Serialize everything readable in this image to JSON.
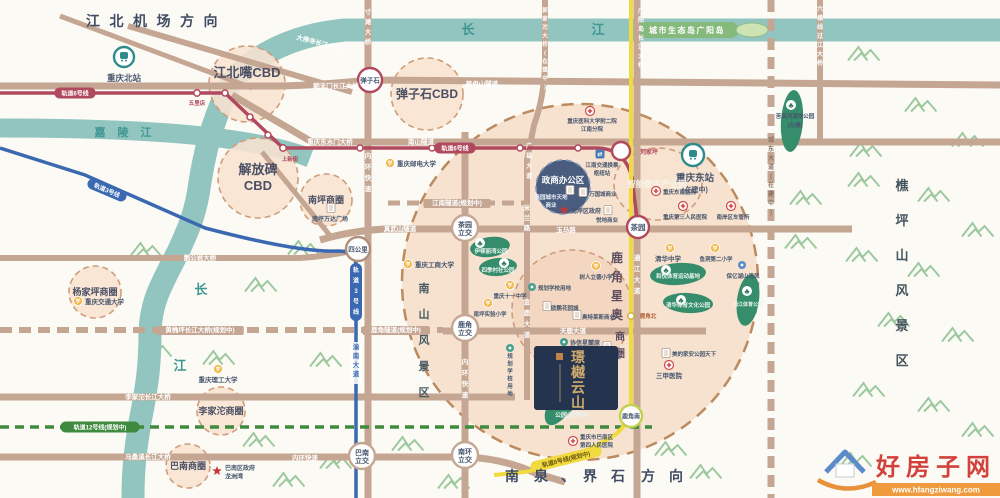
{
  "project": {
    "name": "璟樾云山"
  },
  "directions": {
    "airport": "江北机场方向",
    "south": "南泉、界石方向"
  },
  "rivers": {
    "yangtze": "长江",
    "jialing": "嘉陵江",
    "eco_island": "城市生态岛广阳岛"
  },
  "scenic": {
    "nanshan": "南山风景区",
    "qiaopingshan": "樵坪山风景区"
  },
  "metro_lines": [
    {
      "id": "line6",
      "label": "轨道6号线",
      "color": "#b0495e"
    },
    {
      "id": "line3",
      "label": "轨道3号线",
      "color": "#3a69b1"
    },
    {
      "id": "line12",
      "label": "轨道12号线(规划中)",
      "color": "#3e8a3e"
    },
    {
      "id": "line8",
      "label": "轨道8号线(规划中)",
      "color": "#f0da3d"
    }
  ],
  "metro_pills": [
    {
      "t": "轨道6号线",
      "x": 75,
      "y": 93,
      "c": "#b0495e"
    },
    {
      "t": "轨道6号线",
      "x": 455,
      "y": 148,
      "c": "#b0495e"
    },
    {
      "t": "轨道3号线",
      "x": 107,
      "y": 190,
      "c": "#3a69b1",
      "rot": 23
    },
    {
      "t": "轨道3号线",
      "x": 356,
      "y": 292,
      "c": "#3a69b1",
      "vert": 1
    },
    {
      "t": "轨道12号线(规划中)",
      "x": 100,
      "y": 427,
      "c": "#3e8a3e"
    },
    {
      "t": "轨道8号线(规划中)",
      "x": 566,
      "y": 459,
      "c": "#f0da3d",
      "tc": "#6b5510",
      "rot": -14
    }
  ],
  "stations": [
    {
      "name": "弹子石",
      "x": 370,
      "y": 80,
      "r": 12,
      "ring": "#b0495e",
      "mode": "inside",
      "fs": 6.5
    },
    {
      "name": "刘家坪",
      "x": 621,
      "y": 151,
      "r": 9,
      "ring": "#b0495e",
      "mode": "at",
      "lx": 649,
      "ly": 154,
      "fs": 6,
      "tf": "#b0495e"
    },
    {
      "name": "茶园",
      "x": 638,
      "y": 227,
      "r": 11,
      "ring": "#b0495e",
      "mode": "inside",
      "fs": 7.5
    },
    {
      "name": "四公里",
      "x": 358,
      "y": 249,
      "r": 12,
      "ring": "#b0907c",
      "mode": "inside",
      "fs": 6.5
    },
    {
      "name": "鹿角南",
      "x": 631,
      "y": 416,
      "r": 11,
      "ring": "#c3cf52",
      "mode": "inside",
      "fs": 6
    },
    {
      "name": "茶园立交",
      "x": 465,
      "y": 228,
      "r": 13,
      "ring": "#c4a693",
      "mode": "inside2",
      "fs": 7
    },
    {
      "name": "鹿角立交",
      "x": 465,
      "y": 328,
      "r": 13,
      "ring": "#c4a693",
      "mode": "inside2",
      "fs": 7
    },
    {
      "name": "巴南立交",
      "x": 362,
      "y": 456,
      "r": 13,
      "ring": "#c4a693",
      "mode": "inside2",
      "fs": 7
    },
    {
      "name": "南环立交",
      "x": 465,
      "y": 455,
      "r": 13,
      "ring": "#c4a693",
      "mode": "inside2",
      "fs": 7
    },
    {
      "name": "五里店",
      "x": 197,
      "y": 93,
      "r": 3.2,
      "ring": "#b0495e",
      "mode": "at",
      "lx": 197,
      "ly": 105,
      "fs": 5.5,
      "tf": "#b0495e"
    },
    {
      "name": "上新街",
      "x": 283,
      "y": 148,
      "r": 3.2,
      "ring": "#b0495e",
      "mode": "at",
      "lx": 290,
      "ly": 161,
      "fs": 5.5,
      "tf": "#b0495e"
    },
    {
      "name": "鹿角北",
      "x": 631,
      "y": 316,
      "r": 3.2,
      "ring": "#cdb23a",
      "mode": "at",
      "lx": 648,
      "ly": 318,
      "fs": 5.5,
      "tf": "#b0613a"
    },
    {
      "name": "重庆北站",
      "x": 124,
      "y": 57,
      "r": 10,
      "ring": "#2e8b8b",
      "type": "train",
      "mode": "at",
      "lx": 124,
      "ly": 81,
      "fs": 8.5
    },
    {
      "name": "重庆东站",
      "x": 693,
      "y": 155,
      "r": 11,
      "ring": "#2e8b8b",
      "type": "train",
      "mode": "at",
      "lx": 695,
      "ly": 181,
      "fs": 9.5,
      "sub": "(在建中)",
      "sx": 695,
      "sy": 192
    }
  ],
  "districts": [
    {
      "name": "茶园新区",
      "type": "outer",
      "x": 580,
      "y": 282,
      "r": 178
    },
    {
      "name": "江北嘴CBD",
      "x": 247,
      "y": 84,
      "r": 38,
      "lx": 247,
      "ly": 77,
      "fs": 13
    },
    {
      "name": "解放碑CBD",
      "x": 258,
      "y": 178,
      "r": 40,
      "lines": [
        "解放碑",
        "CBD"
      ],
      "lx": 258,
      "ly": 174,
      "fs": 13
    },
    {
      "name": "弹子石CBD",
      "x": 427,
      "y": 94,
      "r": 36,
      "lx": 427,
      "ly": 98,
      "fs": 12
    },
    {
      "name": "南坪商圈",
      "x": 326,
      "y": 200,
      "r": 26,
      "lx": 326,
      "ly": 203,
      "fs": 9
    },
    {
      "name": "杨家坪商圈",
      "x": 95,
      "y": 292,
      "r": 26,
      "lx": 95,
      "ly": 295,
      "fs": 9
    },
    {
      "name": "李家沱商圈",
      "x": 221,
      "y": 411,
      "r": 24,
      "lx": 221,
      "ly": 414,
      "fs": 9
    },
    {
      "name": "巴南商圈",
      "x": 188,
      "y": 466,
      "r": 22,
      "lx": 188,
      "ly": 469,
      "fs": 9
    },
    {
      "name": "鹿角星奥商圈",
      "x": 572,
      "y": 310,
      "r": 60,
      "fill": "#f0cdb6",
      "op": 0.55,
      "vert": 1
    },
    {
      "name": "智能数字产业园",
      "x": 658,
      "y": 184,
      "rx": 44,
      "ry": 36,
      "lx": 657,
      "ly": 187,
      "fs": 8.5,
      "tfill": "#f7f4e8"
    },
    {
      "name": "政商办公区",
      "x": 563,
      "y": 187,
      "r": 27,
      "fill": "#44597c",
      "op": 0.97,
      "stroke": "#8296b8",
      "lx": 563,
      "ly": 183,
      "fs": 8.5,
      "tfill": "#ffffff"
    }
  ],
  "luojiao_vertical": {
    "main": "鹿角星奥",
    "sub": "商圈"
  },
  "road_labels": [
    {
      "t": "大佛寺长江大桥",
      "x": 318,
      "y": 45,
      "rot": 15
    },
    {
      "t": "朝天门长江大桥",
      "x": 336,
      "y": 88
    },
    {
      "t": "慈母山隧道",
      "x": 482,
      "y": 86
    },
    {
      "t": "重庆东水门大桥",
      "x": 330,
      "y": 144
    },
    {
      "t": "南山隧道",
      "x": 421,
      "y": 144
    },
    {
      "t": "鹅公岩大桥",
      "x": 200,
      "y": 260
    },
    {
      "t": "黄桷坪长江大桥(规划中)",
      "x": 200,
      "y": 332,
      "bg": 1
    },
    {
      "t": "李家沱长江大桥",
      "x": 148,
      "y": 399
    },
    {
      "t": "马桑溪长江大桥",
      "x": 148,
      "y": 459
    },
    {
      "t": "内环快速",
      "x": 305,
      "y": 460
    },
    {
      "t": "真武山隧道",
      "x": 400,
      "y": 231
    },
    {
      "t": "江南隧道(规划中)",
      "x": 457,
      "y": 205,
      "bg": 1
    },
    {
      "t": "鹿角隧道(规划中)",
      "x": 396,
      "y": 332,
      "bg": 1
    },
    {
      "t": "天鹿大道",
      "x": 573,
      "y": 333
    },
    {
      "t": "玉马路",
      "x": 566,
      "y": 232
    },
    {
      "t": "寸滩大桥",
      "x": 368,
      "y": 14,
      "vert": 1,
      "dy": 10
    },
    {
      "t": "郭家沱大桥(在建中)",
      "x": 545,
      "y": 12,
      "vert": 1,
      "dy": 8.5,
      "fs": 5.5
    },
    {
      "t": "广阳岛长江大桥",
      "x": 641,
      "y": 13,
      "vert": 1,
      "dy": 9,
      "fs": 6
    },
    {
      "t": "六横线过江大桥",
      "x": 820,
      "y": 11,
      "vert": 1,
      "dy": 9,
      "fs": 6
    },
    {
      "t": "城东大道(在建中)",
      "x": 771,
      "y": 142,
      "vert": 1,
      "dy": 9,
      "fs": 6,
      "fill": "#8a7263"
    },
    {
      "t": "内环快速",
      "x": 368,
      "y": 158,
      "vert": 1,
      "dy": 11
    },
    {
      "t": "内环快速",
      "x": 465,
      "y": 364,
      "vert": 1,
      "dy": 11
    },
    {
      "t": "广福大道",
      "x": 529,
      "y": 148,
      "vert": 1,
      "dy": 10,
      "fs": 6
    },
    {
      "t": "米兰路",
      "x": 527,
      "y": 210,
      "vert": 1,
      "dy": 10
    },
    {
      "t": "金鹿大道",
      "x": 527,
      "y": 304,
      "vert": 1,
      "dy": 11
    },
    {
      "t": "通江大道",
      "x": 637,
      "y": 260,
      "vert": 1,
      "dy": 11
    },
    {
      "t": "渝南大道",
      "x": 356,
      "y": 349,
      "vert": 1,
      "dy": 9,
      "fill": "#3a69b1",
      "bgw": 1
    }
  ],
  "pois": [
    {
      "k": "school",
      "x": 390,
      "y": 163,
      "t": "重庆邮电大学",
      "lx": 397,
      "ly": 166,
      "a": "start"
    },
    {
      "k": "school",
      "x": 408,
      "y": 264,
      "t": "重庆工商大学",
      "lx": 415,
      "ly": 267,
      "a": "start"
    },
    {
      "k": "school",
      "x": 218,
      "y": 369,
      "t": "重庆理工大学",
      "lx": 218,
      "ly": 382
    },
    {
      "k": "school",
      "x": 78,
      "y": 301,
      "t": "重庆交通大学",
      "lx": 85,
      "ly": 304,
      "a": "start"
    },
    {
      "k": "school",
      "x": 670,
      "y": 248,
      "t": "清华中学",
      "lx": 668,
      "ly": 261
    },
    {
      "k": "school",
      "x": 715,
      "y": 248,
      "t": "鱼洞第二小学",
      "lx": 716,
      "ly": 261,
      "fs": 5.5
    },
    {
      "k": "school",
      "x": 596,
      "y": 266,
      "t": "树人立德小学",
      "lx": 596,
      "ly": 279,
      "fs": 5.5
    },
    {
      "k": "school",
      "x": 510,
      "y": 285,
      "t": "重庆十一中学",
      "lx": 510,
      "ly": 298,
      "fs": 5.5
    },
    {
      "k": "school",
      "x": 488,
      "y": 303,
      "t": "南坪实验小学",
      "lx": 490,
      "ly": 316,
      "fs": 5.5
    },
    {
      "k": "planned",
      "x": 532,
      "y": 287,
      "t": "规划学校用地",
      "lx": 538,
      "ly": 290,
      "a": "start",
      "fs": 5.5
    },
    {
      "k": "planned",
      "x": 510,
      "y": 348,
      "t": "规划学校用地",
      "vert": 1,
      "vx": 510,
      "vy": 358,
      "vdy": 7.5,
      "fs": 5.5
    },
    {
      "k": "hosp",
      "x": 590,
      "y": 111,
      "lines": [
        "重庆医科大学附二院",
        "江南分院"
      ],
      "lx": 592,
      "ly": 123,
      "fs": 5.5
    },
    {
      "k": "hosp",
      "x": 656,
      "y": 191,
      "t": "重庆东南医院",
      "lx": 663,
      "ly": 194,
      "a": "start",
      "fs": 5.5
    },
    {
      "k": "hosp",
      "x": 683,
      "y": 206,
      "t": "重庆第三人民医院",
      "lx": 685,
      "ly": 219,
      "fs": 5.5
    },
    {
      "k": "hosp",
      "x": 731,
      "y": 206,
      "t": "南岸区车管所",
      "lx": 733,
      "ly": 219,
      "fs": 5.5
    },
    {
      "k": "hosp",
      "x": 669,
      "y": 365,
      "t": "三甲医院",
      "lx": 669,
      "ly": 378,
      "fs": 6.5
    },
    {
      "k": "hosp",
      "x": 573,
      "y": 441,
      "lines": [
        "重庆市巴南区",
        "第四人民医院"
      ],
      "lx": 580,
      "ly": 439,
      "a": "start",
      "fs": 5.5
    },
    {
      "k": "gov",
      "x": 564,
      "y": 210,
      "t": "南岸区政府",
      "lx": 571,
      "ly": 213,
      "a": "start",
      "fs": 6
    },
    {
      "k": "gov",
      "x": 217,
      "y": 471,
      "lines": [
        "巴南区政府",
        "龙洲湾"
      ],
      "lx": 225,
      "ly": 470,
      "a": "start",
      "fs": 6
    },
    {
      "k": "hub",
      "x": 600,
      "y": 154,
      "lines": [
        "江南交通换乘",
        "枢纽站"
      ],
      "lx": 602,
      "ly": 167,
      "fs": 5.5
    },
    {
      "k": "biz",
      "x": 331,
      "y": 208,
      "t": "南坪万达广场",
      "lx": 330,
      "ly": 221,
      "fs": 6
    },
    {
      "k": "biz",
      "x": 583,
      "y": 192,
      "t": "万国城商业",
      "lx": 589,
      "ly": 196,
      "a": "start",
      "fs": 5.5
    },
    {
      "k": "biz",
      "x": 608,
      "y": 210,
      "t": "悦地商业",
      "lx": 607,
      "ly": 222,
      "fs": 5.5
    },
    {
      "k": "biz",
      "x": 570,
      "y": 190,
      "lines": [
        "奥园城市天地",
        "商业"
      ],
      "lx": 551,
      "ly": 199,
      "fs": 5.5,
      "fill": "#e9eef7"
    },
    {
      "k": "biz",
      "x": 577,
      "y": 315,
      "t": "奥特莱斯商业",
      "lx": 582,
      "ly": 319,
      "a": "start",
      "fs": 5.5
    },
    {
      "k": "biz",
      "x": 547,
      "y": 306,
      "t": "欧鹏花园城",
      "lx": 551,
      "ly": 310,
      "a": "start",
      "fs": 5.5
    },
    {
      "k": "tealc",
      "x": 564,
      "y": 342,
      "t": "协信星麓原",
      "lx": 570,
      "ly": 345,
      "a": "start",
      "fs": 6
    },
    {
      "k": "biz",
      "x": 607,
      "y": 346,
      "t": "星澜汇商业",
      "lx": 607,
      "ly": 359,
      "fs": 5.5
    },
    {
      "k": "bluec",
      "x": 742,
      "y": 265,
      "t": "保亿湖山清风",
      "lx": 743,
      "ly": 278,
      "fs": 5.5
    },
    {
      "k": "biz",
      "x": 666,
      "y": 353,
      "t": "美的家安公园天下",
      "lx": 672,
      "ly": 356,
      "a": "start",
      "fs": 5.5
    }
  ],
  "park_labels": [
    {
      "t": "伊顿丽湾公园",
      "x": 491,
      "y": 253
    },
    {
      "t": "四季村社公园",
      "x": 498,
      "y": 272
    },
    {
      "t": "和悦体育运动基地",
      "x": 678,
      "y": 278
    },
    {
      "t": "清华体育文化公园",
      "x": 688,
      "y": 307
    },
    {
      "t": "通江体育公园",
      "x": 748,
      "y": 306,
      "fs": 5
    },
    {
      "t": "公园(规划中)",
      "x": 572,
      "y": 417,
      "fs": 6
    },
    {
      "t": "苦溪河湿地公园",
      "x": 795,
      "y": 118,
      "fill": "#47566e"
    },
    {
      "t": "(在建)",
      "x": 795,
      "y": 127,
      "fill": "#47566e"
    }
  ],
  "watermark": {
    "site": "好房子网",
    "url": "www.hfangziwang.com"
  }
}
